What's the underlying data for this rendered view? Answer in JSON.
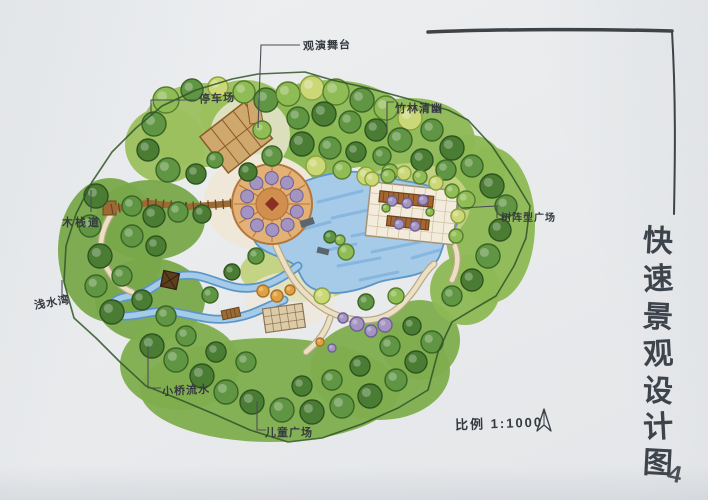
{
  "title": {
    "vertical_text": "快速景观设计图",
    "chars": [
      "快",
      "速",
      "景",
      "观",
      "设",
      "计",
      "图"
    ],
    "page_number": "4"
  },
  "scale": {
    "label": "比例 1:1000"
  },
  "plan_labels": {
    "stage": "观演舞台",
    "parking": "停车场",
    "bamboo": "竹林清幽",
    "boardwalk": "木栈道",
    "waterfront": "浅水湾",
    "bridge": "小桥流水",
    "children": "儿童广场",
    "tree_plaza": "树阵型广场"
  },
  "icons": {
    "north_arrow": "north-arrow-icon"
  },
  "colors": {
    "paper": "#e9ebed",
    "ink": "#3b4047",
    "site_outline": "#2f5526",
    "foliage_light": "#9cc05e",
    "foliage_mid": "#8db954",
    "foliage_deep": "#79a84a",
    "foliage_bottom": "#7fae4e",
    "lawn": "#c3d37e",
    "water": "#a6cbe8",
    "water_edge": "#5b96c8",
    "water_hatch": "#74a9d8",
    "plaza_tan": "#e3b176",
    "plaza_tan_dark": "#b5763c",
    "plaza_inner": "#d08f4e",
    "plaza_center_red": "#8a2f23",
    "wood": "#9c6a33",
    "wood_dark": "#6b4620",
    "path_fill": "#ece0c4",
    "path_edge": "#b9a986",
    "cream": "#efe8d8",
    "grid_plaza": "#f3ecdc",
    "pergola": "#a5672f",
    "dock_gray": "#5a666f",
    "tree_palette": [
      [
        "#b7cf6d",
        "#74933b"
      ],
      [
        "#8fbc55",
        "#567d2e"
      ],
      [
        "#609544",
        "#3a6524"
      ],
      [
        "#ccd878",
        "#8aa23f"
      ],
      [
        "#a394c2",
        "#6f5f95"
      ],
      [
        "#e0a13e",
        "#a8702a"
      ],
      [
        "#4a7c33",
        "#2e5420"
      ]
    ]
  }
}
